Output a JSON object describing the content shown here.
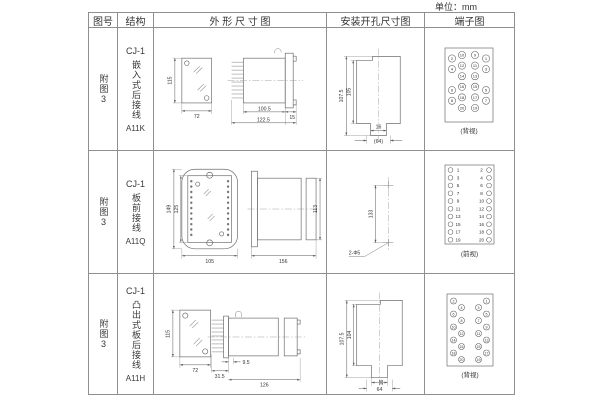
{
  "page": {
    "unit_label": "单位：mm"
  },
  "table": {
    "headers": {
      "fig_no": "图号",
      "structure": "结构",
      "outline": "外 形 尺 寸 图",
      "mounting": "安装开孔尺寸图",
      "terminal": "端子图"
    }
  },
  "rows": [
    {
      "fig_no": "附图3",
      "structure": {
        "model": "CJ-1",
        "mount_type": "嵌入式后接线",
        "code": "A11K"
      },
      "outline": {
        "front_height": "115",
        "front_width": "72",
        "body_length": "100.5",
        "overall_length": "122.5",
        "panel_depth": "15"
      },
      "mounting": {
        "outer_height": "107.5",
        "inner_height": "105",
        "slot_width": "16",
        "overall_width": "(64)"
      },
      "terminal": {
        "caption": "(背视)",
        "outer_left": [
          "2",
          "4",
          "6",
          "8"
        ],
        "inner_left": [
          "10",
          "12",
          "14",
          "16",
          "18",
          "20"
        ],
        "inner_right": [
          "9",
          "11",
          "13",
          "15",
          "17",
          "19"
        ],
        "outer_right": [
          "1",
          "3",
          "5",
          "7"
        ]
      }
    },
    {
      "fig_no": "附图3",
      "structure": {
        "model": "CJ-1",
        "mount_type": "板前接线",
        "code": "A11Q"
      },
      "outline": {
        "front_outer_height": "149",
        "front_inner_height": "125",
        "front_width": "105",
        "overall_length": "156",
        "side_height": "113"
      },
      "mounting": {
        "hole_spacing": "133",
        "hole_label": "2-Φ5"
      },
      "terminal": {
        "caption": "(前视)",
        "left_numbers": [
          "1",
          "3",
          "5",
          "7",
          "9",
          "11",
          "13",
          "15",
          "17",
          "19"
        ],
        "right_numbers": [
          "2",
          "4",
          "6",
          "8",
          "10",
          "12",
          "14",
          "16",
          "18",
          "20"
        ]
      }
    },
    {
      "fig_no": "附图3",
      "structure": {
        "model": "CJ-1",
        "mount_type": "凸出式板后接线",
        "code": "A11H"
      },
      "outline": {
        "front_height": "115",
        "front_width": "72",
        "pin_depth": "31.5",
        "stub_length": "9.5",
        "overall_length": "126"
      },
      "mounting": {
        "outer_height": "107.5",
        "inner_height": "104",
        "slot_width": "16",
        "overall_width": "64"
      },
      "terminal": {
        "caption": "(背视)",
        "outer_left": [
          "2",
          "6",
          "10",
          "14",
          "18"
        ],
        "inner_left": [
          "4",
          "8",
          "12",
          "16",
          "20"
        ],
        "inner_right": [
          "3",
          "7",
          "11",
          "15",
          "19"
        ],
        "outer_right": [
          "1",
          "5",
          "9",
          "13",
          "17"
        ]
      }
    }
  ]
}
